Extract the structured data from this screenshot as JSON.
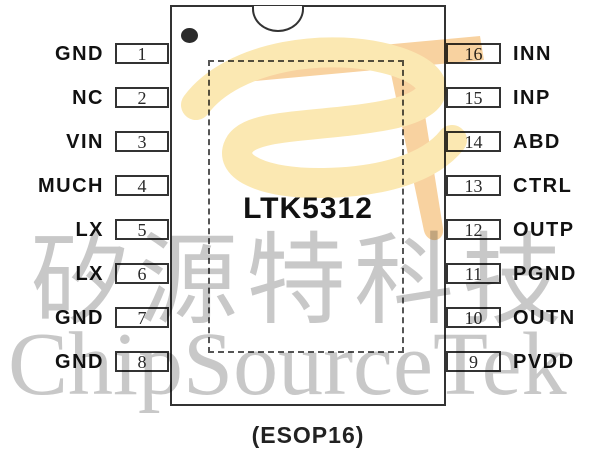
{
  "chip": {
    "name": "LTK5312",
    "package_label": "(ESOP16)"
  },
  "left_pins": [
    {
      "number": "1",
      "name": "GND"
    },
    {
      "number": "2",
      "name": "NC"
    },
    {
      "number": "3",
      "name": "VIN"
    },
    {
      "number": "4",
      "name": "MUCH"
    },
    {
      "number": "5",
      "name": "LX"
    },
    {
      "number": "6",
      "name": "LX"
    },
    {
      "number": "7",
      "name": "GND"
    },
    {
      "number": "8",
      "name": "GND"
    }
  ],
  "right_pins": [
    {
      "number": "16",
      "name": "INN"
    },
    {
      "number": "15",
      "name": "INP"
    },
    {
      "number": "14",
      "name": "ABD"
    },
    {
      "number": "13",
      "name": "CTRL"
    },
    {
      "number": "12",
      "name": "OUTP"
    },
    {
      "number": "11",
      "name": "PGND"
    },
    {
      "number": "10",
      "name": "OUTN"
    },
    {
      "number": "9",
      "name": "PVDD"
    }
  ],
  "watermark": {
    "cjk_text": "矽源特科技",
    "latin_text": "ChipSourceTek",
    "text_color": "#c8c8c8",
    "logo_orange": "#f8d2a0",
    "logo_yellow": "#fbe8b2"
  },
  "colors": {
    "line": "#333333",
    "label_text": "#111111",
    "background": "#ffffff"
  }
}
